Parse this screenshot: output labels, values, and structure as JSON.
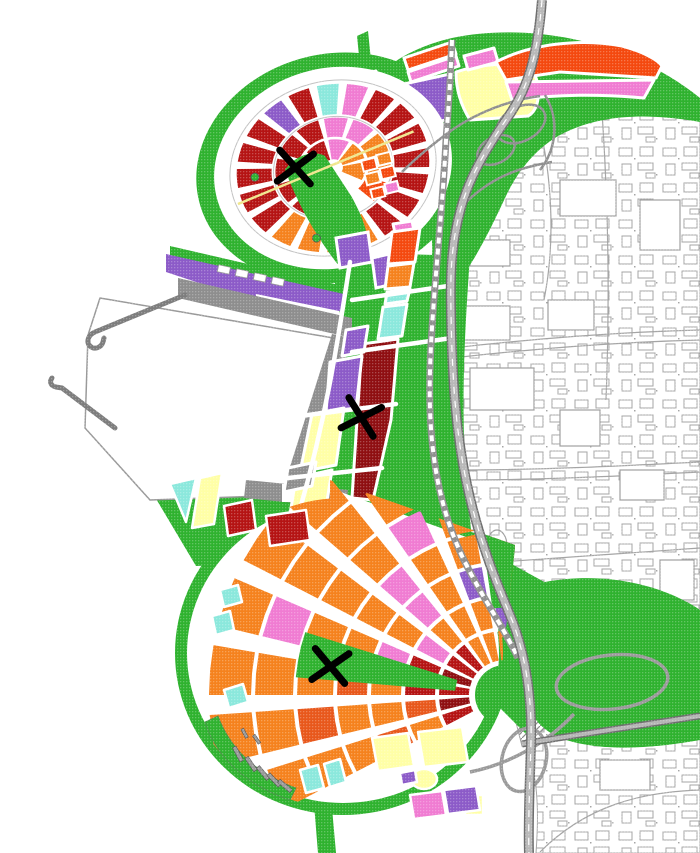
{
  "map": {
    "kind": "land-use-masterplan",
    "canvas": {
      "width": 700,
      "height": 853
    },
    "palette": {
      "background": "#ffffff",
      "green": "#2fb22f",
      "darkRed": "#b51414",
      "deepRed": "#8f0f12",
      "orange": "#f5821e",
      "deepOrange": "#e8581c",
      "orangeRed": "#f4490f",
      "pink": "#f07cd2",
      "purple": "#8c5bc8",
      "cyan": "#8be8dc",
      "yellow": "#ffffa6",
      "quayGray": "#8e8e8e",
      "roadGray": "#b5b5b5",
      "roadCasing": "#6e6e6e",
      "railGray": "#8f8f8f",
      "cityLine": "#a5a5a5",
      "marker": "#000000"
    },
    "markers": {
      "symbol": "X",
      "items": [
        {
          "id": "north-district-x",
          "x": 295,
          "y": 167,
          "rot": 10
        },
        {
          "id": "central-spine-x",
          "x": 361,
          "y": 417,
          "rot": 20
        },
        {
          "id": "south-district-x",
          "x": 330,
          "y": 666,
          "rot": 12
        }
      ]
    },
    "features": [
      "north-circular-district",
      "top-band-parcels",
      "highway-interchange-north",
      "existing-city-fabric",
      "harbor-basin",
      "quay",
      "breakwater-piers",
      "central-spine-parcels",
      "railway-line",
      "rail-yard",
      "south-fan-district",
      "marina",
      "highway",
      "highway-interchange-south",
      "park-green-bands"
    ]
  }
}
